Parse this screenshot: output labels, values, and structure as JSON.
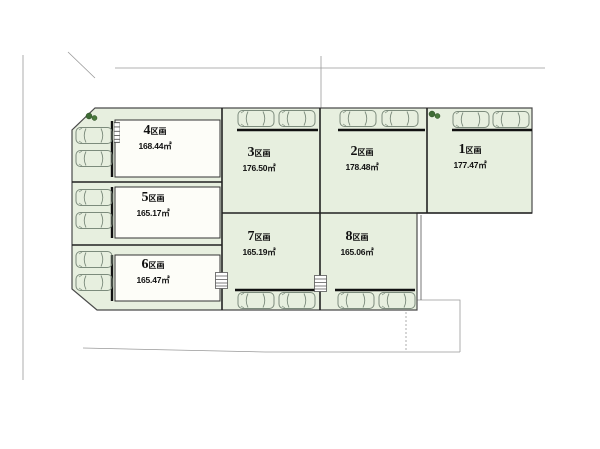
{
  "diagram": {
    "type": "land-plot-layout",
    "colors": {
      "plot_fill": "#e7efdf",
      "building_fill": "#fdfdf8",
      "boundary_line": "#444444",
      "tree_green": "#3f6b3a"
    },
    "plots": [
      {
        "no": "1",
        "suffix": "区画",
        "area": "177.47㎡",
        "x": 470,
        "y": 143
      },
      {
        "no": "2",
        "suffix": "区画",
        "area": "178.48㎡",
        "x": 362,
        "y": 145
      },
      {
        "no": "3",
        "suffix": "区画",
        "area": "176.50㎡",
        "x": 259,
        "y": 146
      },
      {
        "no": "4",
        "suffix": "区画",
        "area": "168.44㎡",
        "x": 155,
        "y": 124
      },
      {
        "no": "5",
        "suffix": "区画",
        "area": "165.17㎡",
        "x": 153,
        "y": 191
      },
      {
        "no": "6",
        "suffix": "区画",
        "area": "165.47㎡",
        "x": 153,
        "y": 258
      },
      {
        "no": "7",
        "suffix": "区画",
        "area": "165.19㎡",
        "x": 259,
        "y": 230
      },
      {
        "no": "8",
        "suffix": "区画",
        "area": "165.06㎡",
        "x": 357,
        "y": 230
      }
    ],
    "roads": [
      {
        "text": "公道幅5.2m",
        "x": 347,
        "y": 80
      },
      {
        "text": "公道約4.7m",
        "x": 40,
        "y": 234
      },
      {
        "text": "公道約5.2m",
        "x": 424,
        "y": 322
      }
    ],
    "elevations": [
      {
        "text": "FH48.41",
        "x": 48,
        "y": 90
      },
      {
        "text": "FH47.41",
        "x": 199,
        "y": 91
      },
      {
        "text": "FH48.09",
        "x": 281,
        "y": 92
      },
      {
        "text": "FH46.02",
        "x": 358,
        "y": 92
      },
      {
        "text": "FH47.36",
        "x": 39,
        "y": 159
      },
      {
        "text": "FH46.18",
        "x": 39,
        "y": 200
      },
      {
        "text": "FH45.47",
        "x": 47,
        "y": 251
      },
      {
        "text": "FH45.47",
        "x": 48,
        "y": 321
      },
      {
        "text": "FH45.25",
        "x": 97,
        "y": 332
      },
      {
        "text": "FH44.51",
        "x": 207,
        "y": 332
      },
      {
        "text": "FH43.41",
        "x": 342,
        "y": 333
      }
    ],
    "dimensions": [
      {
        "text": "17.010",
        "x": 150,
        "y": 100
      },
      {
        "text": "13.410",
        "x": 277,
        "y": 100
      },
      {
        "text": "12.148",
        "x": 368,
        "y": 102
      },
      {
        "text": "1.272",
        "x": 424,
        "y": 100
      },
      {
        "text": "13.156",
        "x": 483,
        "y": 100
      },
      {
        "text": "12.765",
        "x": 150,
        "y": 174
      },
      {
        "text": "12.956",
        "x": 266,
        "y": 210
      },
      {
        "text": "0.502",
        "x": 322,
        "y": 210
      },
      {
        "text": "11.746",
        "x": 371,
        "y": 210
      },
      {
        "text": "1.990",
        "x": 420,
        "y": 210
      },
      {
        "text": "13.489",
        "x": 482,
        "y": 210
      },
      {
        "text": "10.192",
        "x": 146,
        "y": 242
      },
      {
        "text": "17.039",
        "x": 148,
        "y": 312
      },
      {
        "text": "7.705",
        "x": 247,
        "y": 312
      },
      {
        "text": "4.844",
        "x": 296,
        "y": 312
      },
      {
        "text": "12.563",
        "x": 364,
        "y": 312
      },
      {
        "text": "6.700",
        "x": 67,
        "y": 143,
        "rot": -90
      },
      {
        "text": "5.600",
        "x": 66,
        "y": 203,
        "rot": -90
      },
      {
        "text": "6.600",
        "x": 66,
        "y": 265,
        "rot": -90
      },
      {
        "text": "9.573",
        "x": 223,
        "y": 141,
        "rot": -90
      },
      {
        "text": "9.871",
        "x": 223,
        "y": 196,
        "rot": -90
      },
      {
        "text": "9.178",
        "x": 223,
        "y": 262,
        "rot": -90
      },
      {
        "text": "13.731",
        "x": 326,
        "y": 166,
        "rot": -90
      },
      {
        "text": "12.593",
        "x": 430,
        "y": 166,
        "rot": -90
      },
      {
        "text": "10.19",
        "x": 318,
        "y": 251,
        "rot": -90
      },
      {
        "text": "10.19",
        "x": 420,
        "y": 253,
        "rot": -90
      },
      {
        "text": "5.007",
        "x": 81,
        "y": 112,
        "rot": -42
      },
      {
        "text": "2.063",
        "x": 79,
        "y": 301,
        "rot": 42
      }
    ],
    "parking": {
      "cars": [
        {
          "x": 75,
          "y": 126
        },
        {
          "x": 75,
          "y": 149
        },
        {
          "x": 75,
          "y": 188
        },
        {
          "x": 75,
          "y": 211
        },
        {
          "x": 75,
          "y": 250
        },
        {
          "x": 75,
          "y": 273
        },
        {
          "x": 237,
          "y": 109
        },
        {
          "x": 278,
          "y": 109
        },
        {
          "x": 339,
          "y": 109
        },
        {
          "x": 381,
          "y": 109
        },
        {
          "x": 452,
          "y": 110
        },
        {
          "x": 492,
          "y": 110
        },
        {
          "x": 237,
          "y": 291
        },
        {
          "x": 278,
          "y": 291
        },
        {
          "x": 337,
          "y": 291
        },
        {
          "x": 378,
          "y": 291
        }
      ]
    },
    "trees": [
      {
        "x": 85,
        "y": 112
      },
      {
        "x": 428,
        "y": 110
      }
    ],
    "stairs": [
      {
        "x": 215,
        "y": 272,
        "w": 13,
        "h": 17
      },
      {
        "x": 314,
        "y": 275,
        "w": 13,
        "h": 17
      },
      {
        "x": 114,
        "y": 122,
        "w": 6,
        "h": 21
      }
    ]
  }
}
